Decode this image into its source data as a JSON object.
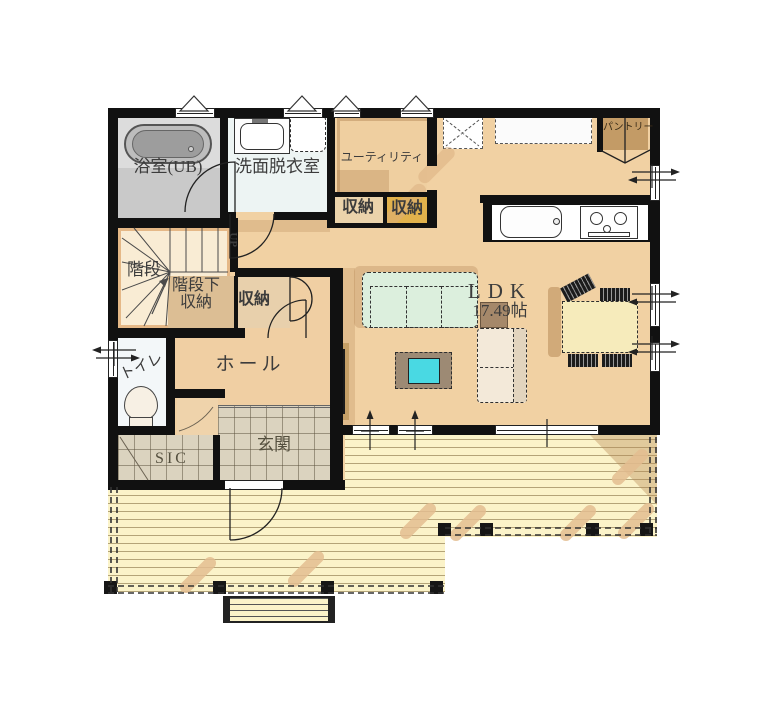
{
  "plan": {
    "rooms": {
      "bathroom": {
        "label": "浴室(UB)"
      },
      "washroom": {
        "label": "洗面脱衣室"
      },
      "utility": {
        "label": "ユーティリティ"
      },
      "utility_storage_left": {
        "label": "収納"
      },
      "utility_storage_right": {
        "label": "収納"
      },
      "pantry": {
        "label": "パントリー"
      },
      "stairs": {
        "label": "階段",
        "direction_label": "UP"
      },
      "understair_storage": {
        "label_line1": "階段下",
        "label_line2": "収納"
      },
      "hall_storage": {
        "label": "収納"
      },
      "hall": {
        "label": "ホール"
      },
      "toilet": {
        "label": "トイレ"
      },
      "shoe_in_closet": {
        "label": "SIC"
      },
      "entrance": {
        "label": "玄関"
      },
      "ldk": {
        "label": "LDK",
        "area": "17.49帖"
      }
    },
    "colors": {
      "wall": "#111111",
      "wood_floor": "#F1D1A3",
      "deck_floor": "#FBF3C9",
      "entrance_tile": "#DBD3BF",
      "bathroom_gray": "#DCDCDC",
      "washroom_white": "#EDF4F3",
      "sofa_mint": "#DCEFDD",
      "table_cyan": "#49D9E3",
      "storage_gold": "#E2B24C",
      "dining_cream": "#F6EBBB"
    }
  }
}
